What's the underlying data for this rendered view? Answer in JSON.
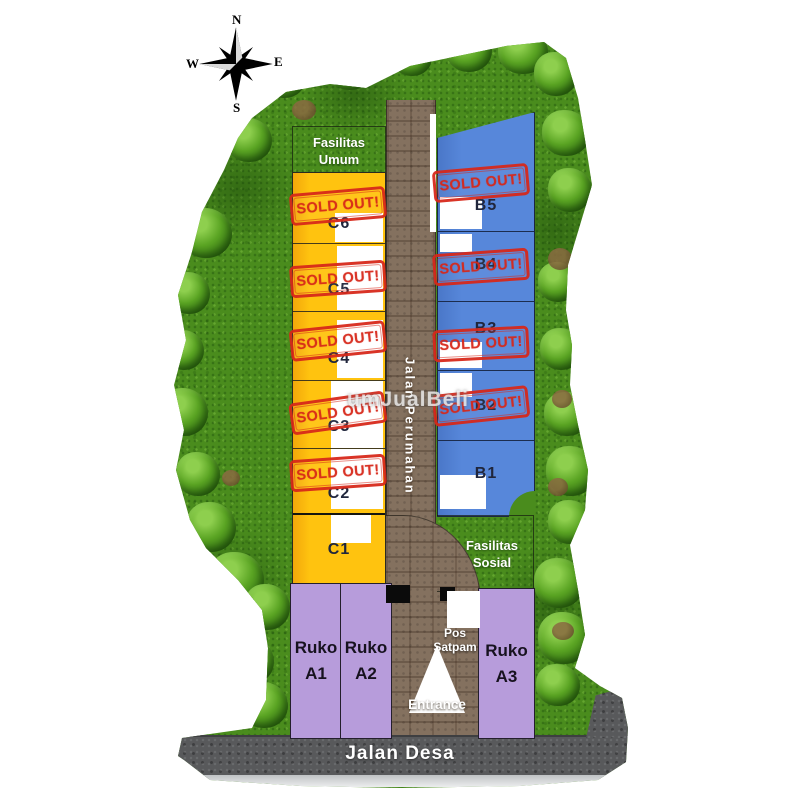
{
  "compass": {
    "north": "N",
    "east": "E",
    "south": "S",
    "west": "W"
  },
  "watermark": "umJualBeli",
  "stamp_text": "SOLD OUT!",
  "facilities": {
    "umum": {
      "line1": "Fasilitas",
      "line2": "Umum"
    },
    "sosial": {
      "line1": "Fasilitas",
      "line2": "Sosial"
    }
  },
  "roads": {
    "main_label": "Jalan Perumahan",
    "village_label": "Jalan Desa",
    "entrance_label": "Entrance"
  },
  "security_post": {
    "line1": "Pos",
    "line2": "Satpam"
  },
  "blocks": {
    "c": {
      "units": [
        {
          "label": "C6",
          "sold": true
        },
        {
          "label": "C5",
          "sold": true
        },
        {
          "label": "C4",
          "sold": true
        },
        {
          "label": "C3",
          "sold": true
        },
        {
          "label": "C2",
          "sold": true
        },
        {
          "label": "C1",
          "sold": false
        }
      ]
    },
    "b": {
      "units": [
        {
          "label": "B5",
          "sold": true
        },
        {
          "label": "B4",
          "sold": true
        },
        {
          "label": "B3",
          "sold": true
        },
        {
          "label": "B2",
          "sold": true
        },
        {
          "label": "B1",
          "sold": false
        }
      ]
    },
    "a": {
      "units": [
        {
          "line1": "Ruko",
          "line2": "A1"
        },
        {
          "line1": "Ruko",
          "line2": "A2"
        },
        {
          "line1": "Ruko",
          "line2": "A3"
        }
      ]
    }
  },
  "colors": {
    "sold_red": "#d7281a",
    "block_c_yellow": "#ffc30f",
    "block_b_blue": "#5787da",
    "block_a_purple": "#b79cdb",
    "grass_green": "#4a8c1d",
    "road_brown": "#84715f",
    "village_road_gray": "#58595b"
  }
}
